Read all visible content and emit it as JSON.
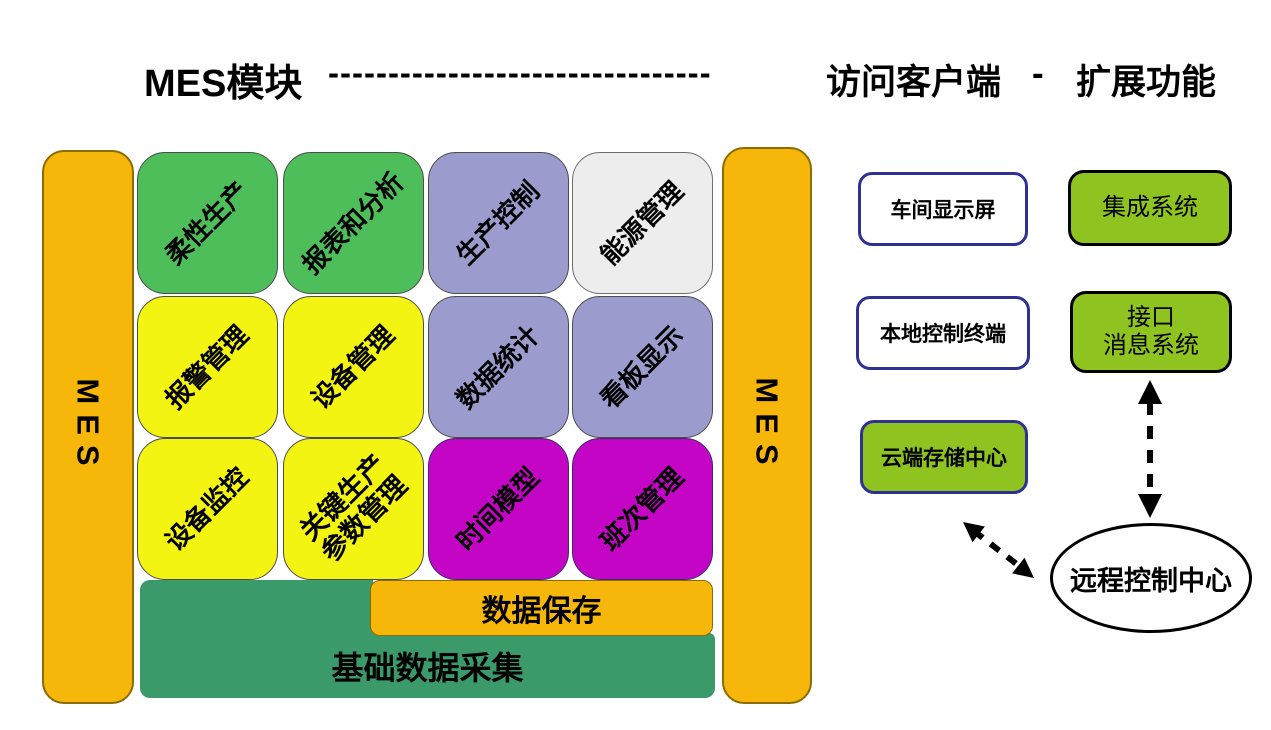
{
  "header": {
    "mes_module": "MES模块",
    "dashes": "--------------------------------",
    "access_client": "访问客户端",
    "separator": "-",
    "extensions": "扩展功能"
  },
  "side_bars": {
    "left_label": "MES",
    "right_label": "MES"
  },
  "modules": {
    "tiles": [
      {
        "label": "柔性生产",
        "color": "#4DBE5A"
      },
      {
        "label": "报表和分析",
        "color": "#4DBE5A"
      },
      {
        "label": "生产控制",
        "color": "#9C9BCE"
      },
      {
        "label": "能源管理",
        "color": "#EDEDED"
      },
      {
        "label": "报警管理",
        "color": "#F4F412"
      },
      {
        "label": "设备管理",
        "color": "#F4F412"
      },
      {
        "label": "数据统计",
        "color": "#9C9BCE"
      },
      {
        "label": "看板显示",
        "color": "#9C9BCE"
      },
      {
        "label": "设备监控",
        "color": "#F4F412"
      },
      {
        "label": "关键生产\n参数管理",
        "color": "#F4F412"
      },
      {
        "label": "时间模型",
        "color": "#C505C5"
      },
      {
        "label": "班次管理",
        "color": "#C505C5"
      }
    ],
    "data_save": "数据保存",
    "base_data_collection": "基础数据采集"
  },
  "access_clients": [
    {
      "label": "车间显示屏"
    },
    {
      "label": "本地控制终端"
    },
    {
      "label": "云端存储中心"
    }
  ],
  "extension_boxes": [
    {
      "label": "集成系统"
    },
    {
      "label": "接口\n消息系统"
    }
  ],
  "remote_center": {
    "label": "远程控制中心"
  },
  "colors": {
    "orange": "#F7B70A",
    "green_tile": "#4DBE5A",
    "yellow_tile": "#F4F412",
    "lavender_tile": "#9C9BCE",
    "white_tile": "#EDEDED",
    "magenta_tile": "#C505C5",
    "sea_green": "#3A9A6A",
    "lime_green": "#8FC31F",
    "navy_border": "#2E3192",
    "arrow_black": "#000000"
  }
}
